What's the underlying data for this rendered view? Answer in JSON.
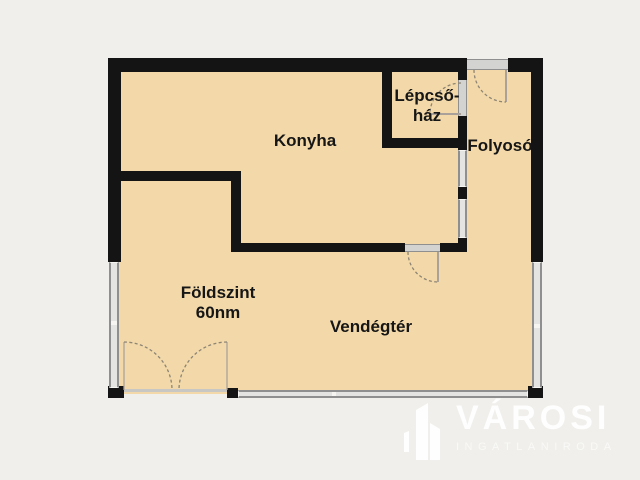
{
  "colors": {
    "background": "#f0efeb",
    "floor": "#f3d9a9",
    "wall": "#141414",
    "window_edge": "#8f8f8f",
    "window_fill": "#e4e4e2",
    "door_fill": "#d3d3d1",
    "arc": "#8d8474",
    "leaf": "#aaa29a",
    "label": "#161616",
    "logo_strong": "rgba(255,255,255,0.92)",
    "logo_soft": "rgba(255,255,255,0.62)"
  },
  "rooms": {
    "konyha": {
      "label": "Konyha"
    },
    "lepcsohaz": {
      "line1": "Lépcső-",
      "line2": "ház"
    },
    "folyoso": {
      "label": "Folyosó"
    },
    "vendegter": {
      "label": "Vendégtér"
    }
  },
  "floor_info": {
    "line1": "Földszint",
    "line2": "60nm"
  },
  "watermark": {
    "brand": "VÁROSI",
    "tagline": "INGATLANIRODA",
    "icon": "buildings-icon"
  }
}
